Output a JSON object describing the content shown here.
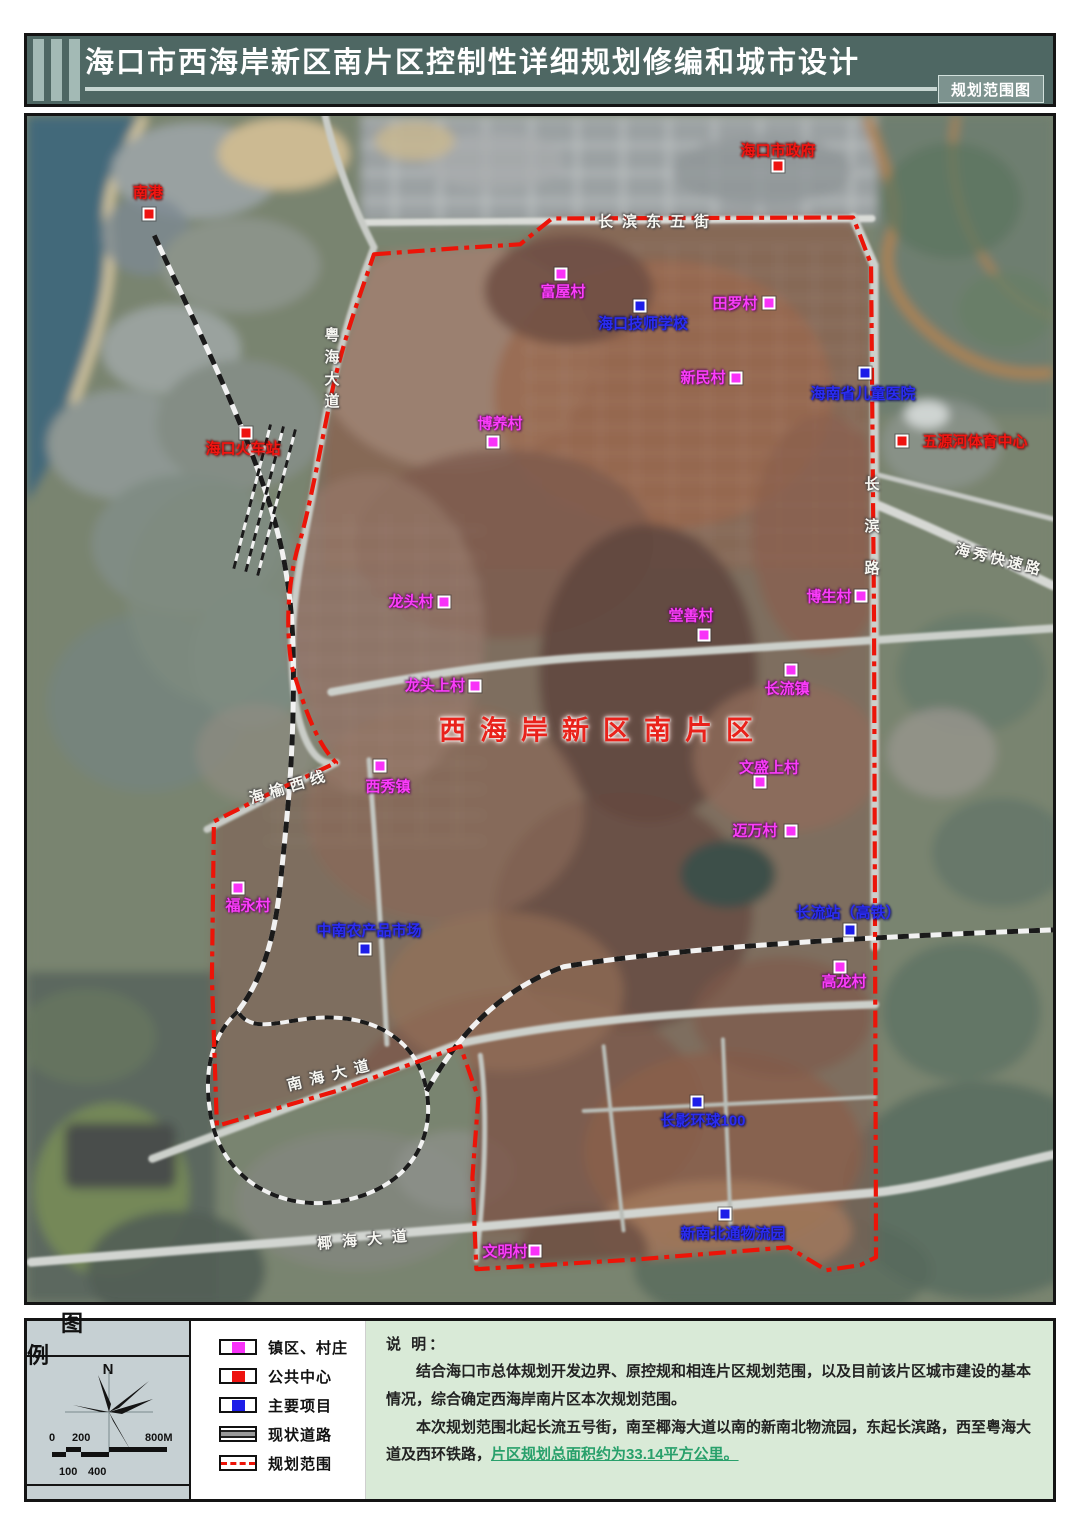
{
  "header": {
    "title": "海口市西海岸新区南片区控制性详细规划修编和城市设计",
    "corner_label": "规划范围图"
  },
  "map": {
    "labels": [
      {
        "id": "nangang",
        "text": "南港",
        "type": "public",
        "x": 121,
        "y": 77,
        "marker": {
          "x": 122,
          "y": 98
        }
      },
      {
        "id": "haikou-gov",
        "text": "海口市政府",
        "type": "public",
        "x": 751,
        "y": 35,
        "marker": {
          "x": 751,
          "y": 50
        }
      },
      {
        "id": "haikou-railway-station",
        "text": "海口火车站",
        "type": "public",
        "x": 216,
        "y": 333,
        "marker": {
          "x": 219,
          "y": 317
        }
      },
      {
        "id": "wuyuanhe-sports",
        "text": "五源河体育中心",
        "type": "public",
        "x": 948,
        "y": 326,
        "marker": {
          "x": 875,
          "y": 325
        }
      },
      {
        "id": "fuwu-village",
        "text": "富屋村",
        "type": "village",
        "x": 536,
        "y": 176,
        "marker": {
          "x": 534,
          "y": 158
        }
      },
      {
        "id": "tianluo-village",
        "text": "田罗村",
        "type": "village",
        "x": 708,
        "y": 188,
        "marker": {
          "x": 742,
          "y": 187
        }
      },
      {
        "id": "xinmin-village",
        "text": "新民村",
        "type": "village",
        "x": 676,
        "y": 262,
        "marker": {
          "x": 709,
          "y": 262
        }
      },
      {
        "id": "boyang-village",
        "text": "博养村",
        "type": "village",
        "x": 473,
        "y": 308,
        "marker": {
          "x": 466,
          "y": 326
        }
      },
      {
        "id": "longtou-village",
        "text": "龙头村",
        "type": "village",
        "x": 384,
        "y": 486,
        "marker": {
          "x": 417,
          "y": 486
        }
      },
      {
        "id": "tangshan-village",
        "text": "堂善村",
        "type": "village",
        "x": 664,
        "y": 500,
        "marker": {
          "x": 677,
          "y": 519
        }
      },
      {
        "id": "bosheng-village",
        "text": "博生村",
        "type": "village",
        "x": 802,
        "y": 481,
        "marker": {
          "x": 834,
          "y": 480
        }
      },
      {
        "id": "longtoushang-village",
        "text": "龙头上村",
        "type": "village",
        "x": 408,
        "y": 570,
        "marker": {
          "x": 448,
          "y": 570
        }
      },
      {
        "id": "changliu-town",
        "text": "长流镇",
        "type": "village",
        "x": 760,
        "y": 573,
        "marker": {
          "x": 764,
          "y": 554
        }
      },
      {
        "id": "xixiu-town",
        "text": "西秀镇",
        "type": "village",
        "x": 361,
        "y": 671,
        "marker": {
          "x": 353,
          "y": 650
        }
      },
      {
        "id": "wenshengshang-village",
        "text": "文盛上村",
        "type": "village",
        "x": 742,
        "y": 652,
        "marker": {
          "x": 733,
          "y": 666
        }
      },
      {
        "id": "maiwan-village",
        "text": "迈万村",
        "type": "village",
        "x": 728,
        "y": 715,
        "marker": {
          "x": 764,
          "y": 715
        }
      },
      {
        "id": "fuyong-village",
        "text": "福永村",
        "type": "village",
        "x": 221,
        "y": 790,
        "marker": {
          "x": 211,
          "y": 772
        }
      },
      {
        "id": "gaolong-village",
        "text": "高龙村",
        "type": "village",
        "x": 817,
        "y": 866,
        "marker": {
          "x": 813,
          "y": 851
        }
      },
      {
        "id": "wenming-village",
        "text": "文明村",
        "type": "village",
        "x": 478,
        "y": 1136,
        "marker": {
          "x": 508,
          "y": 1135
        }
      },
      {
        "id": "haikou-technician-school",
        "text": "海口技师学校",
        "type": "project",
        "x": 616,
        "y": 208,
        "marker": {
          "x": 613,
          "y": 190
        }
      },
      {
        "id": "hainan-children-hospital",
        "text": "海南省儿童医院",
        "type": "project",
        "x": 836,
        "y": 278,
        "marker": {
          "x": 838,
          "y": 257
        }
      },
      {
        "id": "zhongnan-farm-market",
        "text": "中南农产品市场",
        "type": "project",
        "x": 342,
        "y": 815,
        "marker": {
          "x": 338,
          "y": 833
        }
      },
      {
        "id": "changliu-hsr-station",
        "text": "长流站（高铁）",
        "type": "project",
        "x": 821,
        "y": 797,
        "marker": {
          "x": 823,
          "y": 814
        }
      },
      {
        "id": "changying-global-100",
        "text": "长影环球100",
        "type": "project",
        "x": 676,
        "y": 1005,
        "marker": {
          "x": 670,
          "y": 986
        }
      },
      {
        "id": "xinnanbei-logistics",
        "text": "新南北通物流园",
        "type": "project",
        "x": 706,
        "y": 1118,
        "marker": {
          "x": 698,
          "y": 1098
        }
      },
      {
        "id": "changbin-east-5th-st",
        "text": "长滨东五街",
        "type": "road",
        "x": 631,
        "y": 106,
        "spacing": 9
      },
      {
        "id": "yuehai-avenue",
        "text": "粤海大道",
        "type": "road",
        "x": 304,
        "y": 255,
        "vertical": true,
        "spacing": 7
      },
      {
        "id": "changbin-road",
        "text": "长滨路",
        "type": "road",
        "x": 844,
        "y": 423,
        "vertical": true,
        "spacing": 27
      },
      {
        "id": "haixiu-expressway",
        "text": "海秀快速路",
        "type": "road",
        "x": 972,
        "y": 444,
        "rotate": 14,
        "spacing": 3
      },
      {
        "id": "haiyu-west-line",
        "text": "海榆西线",
        "type": "road",
        "x": 263,
        "y": 671,
        "rotate": -17,
        "spacing": 6
      },
      {
        "id": "nanhai-avenue",
        "text": "南海大道",
        "type": "road",
        "x": 305,
        "y": 959,
        "rotate": -14,
        "spacing": 8
      },
      {
        "id": "yehai-avenue",
        "text": "椰海大道",
        "type": "road",
        "x": 340,
        "y": 1124,
        "rotate": -5,
        "spacing": 10
      },
      {
        "id": "area-name",
        "text": "西海岸新区南片区",
        "type": "area-title",
        "x": 576,
        "y": 615,
        "size": 27,
        "spacing": 14
      }
    ]
  },
  "legend": {
    "title": "图 例",
    "north_label": "N",
    "scale": {
      "top_labels": [
        "0",
        "200",
        "800M"
      ],
      "bottom_labels": [
        "100",
        "400"
      ]
    },
    "items": [
      {
        "id": "town-village",
        "label": "镇区、村庄",
        "swatch": "square",
        "color": "#f832f8"
      },
      {
        "id": "public-center",
        "label": "公共中心",
        "swatch": "square",
        "color": "#ee1310"
      },
      {
        "id": "major-project",
        "label": "主要项目",
        "swatch": "square",
        "color": "#1d1de8"
      },
      {
        "id": "existing-road",
        "label": "现状道路",
        "swatch": "road",
        "color": "#9a9a9a"
      },
      {
        "id": "planning-scope",
        "label": "规划范围",
        "swatch": "boundary",
        "color": "#ec1408"
      }
    ]
  },
  "notes": {
    "heading": "说 明：",
    "para1": "结合海口市总体规划开发边界、原控规和相连片区规划范围，以及目前该片区城市建设的基本情况，综合确定西海岸南片区本次规划范围。",
    "para2_normal": "本次规划范围北起长流五号街，南至椰海大道以南的新南北物流园，东起长滨路，西至粤海大道及西环铁路，",
    "para2_highlight": "片区规划总面积约为33.14平方公里。"
  },
  "colors": {
    "header_bg": "#4e6763",
    "boundary_red": "#ec1408",
    "village_magenta": "#f832f8",
    "public_red": "#ee1310",
    "project_blue": "#1d1de8",
    "notes_bg": "#d9ead7",
    "sea": "#43697a"
  }
}
